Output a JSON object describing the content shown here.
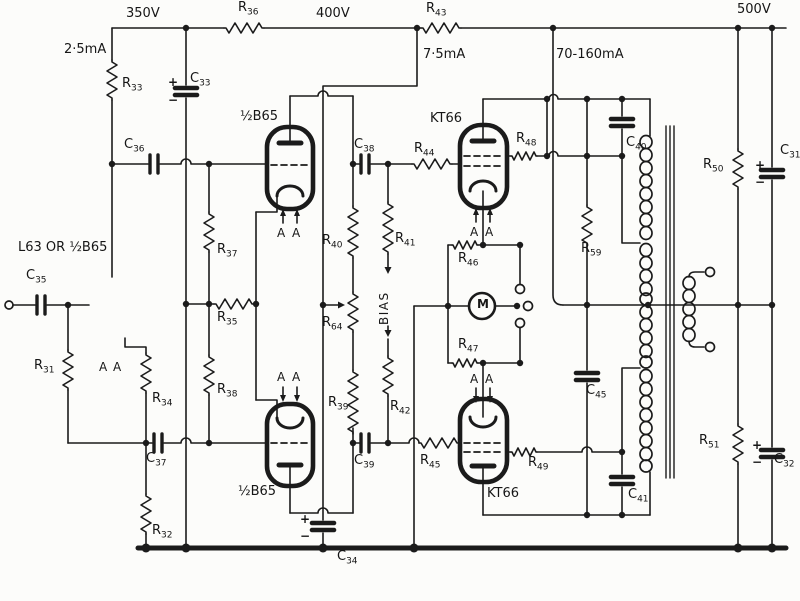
{
  "diagram": {
    "type": "circuit-schematic",
    "subject": "Push-pull KT66 valve power amplifier output stage (Williamson type)",
    "ink_color": "#1b1b1b",
    "paper_color": "#fcfcfa",
    "supply_voltages": [
      "350V",
      "400V",
      "500V"
    ],
    "currents": [
      "2·5mA",
      "7·5mA",
      "70-160mA"
    ],
    "tubes": [
      "L63 OR ½B65",
      "½B65",
      "½B65",
      "KT66",
      "KT66"
    ],
    "meter": "M",
    "bias_label": "BIAS",
    "resistors": [
      "R31",
      "R32",
      "R33",
      "R34",
      "R35",
      "R36",
      "R37",
      "R38",
      "R39",
      "R40",
      "R41",
      "R42",
      "R43",
      "R44",
      "R45",
      "R46",
      "R47",
      "R48",
      "R49",
      "R50",
      "R51",
      "R59",
      "R64"
    ],
    "capacitors": [
      "C31",
      "C32",
      "C33",
      "C34",
      "C35",
      "C36",
      "C37",
      "C38",
      "C39",
      "C40",
      "C41",
      "C45"
    ]
  },
  "labels": {
    "plain": [
      {
        "t": "350V",
        "x": 126,
        "y": 6
      },
      {
        "t": "2·5mA",
        "x": 64,
        "y": 42
      },
      {
        "t": "400V",
        "x": 316,
        "y": 6
      },
      {
        "t": "7·5mA",
        "x": 423,
        "y": 47
      },
      {
        "t": "70-160mA",
        "x": 556,
        "y": 47
      },
      {
        "t": "500V",
        "x": 737,
        "y": 2
      },
      {
        "t": "L63 OR ½B65",
        "x": 18,
        "y": 240
      },
      {
        "t": "½B65",
        "x": 240,
        "y": 109
      },
      {
        "t": "½B65",
        "x": 238,
        "y": 484
      },
      {
        "t": "KT66",
        "x": 430,
        "y": 111
      },
      {
        "t": "KT66",
        "x": 487,
        "y": 486
      },
      {
        "t": "M",
        "x": 477,
        "y": 297,
        "cls": "m"
      },
      {
        "t": "BIAS",
        "x": 377,
        "y": 325,
        "cls": "vert"
      },
      {
        "t": "A",
        "x": 99,
        "y": 360,
        "cls": "aa"
      },
      {
        "t": "A",
        "x": 113,
        "y": 360,
        "cls": "aa"
      },
      {
        "t": "A",
        "x": 277,
        "y": 226,
        "cls": "aa"
      },
      {
        "t": "A",
        "x": 292,
        "y": 226,
        "cls": "aa"
      },
      {
        "t": "A",
        "x": 277,
        "y": 370,
        "cls": "aa"
      },
      {
        "t": "A",
        "x": 292,
        "y": 370,
        "cls": "aa"
      },
      {
        "t": "A",
        "x": 470,
        "y": 225,
        "cls": "aa"
      },
      {
        "t": "A",
        "x": 485,
        "y": 225,
        "cls": "aa"
      },
      {
        "t": "A",
        "x": 470,
        "y": 372,
        "cls": "aa"
      },
      {
        "t": "A",
        "x": 485,
        "y": 372,
        "cls": "aa"
      },
      {
        "t": "+",
        "x": 168,
        "y": 75,
        "cls": "pm"
      },
      {
        "t": "−",
        "x": 168,
        "y": 93,
        "cls": "pm"
      },
      {
        "t": "+",
        "x": 300,
        "y": 512,
        "cls": "pm"
      },
      {
        "t": "−",
        "x": 300,
        "y": 529,
        "cls": "pm"
      },
      {
        "t": "+",
        "x": 755,
        "y": 158,
        "cls": "pm"
      },
      {
        "t": "−",
        "x": 755,
        "y": 175,
        "cls": "pm"
      },
      {
        "t": "+",
        "x": 752,
        "y": 438,
        "cls": "pm"
      },
      {
        "t": "−",
        "x": 752,
        "y": 455,
        "cls": "pm"
      }
    ],
    "subs": [
      {
        "p": "R",
        "s": "36",
        "x": 238,
        "y": 0
      },
      {
        "p": "R",
        "s": "43",
        "x": 426,
        "y": 1
      },
      {
        "p": "R",
        "s": "33",
        "x": 122,
        "y": 76
      },
      {
        "p": "C",
        "s": "33",
        "x": 190,
        "y": 71
      },
      {
        "p": "C",
        "s": "36",
        "x": 124,
        "y": 137
      },
      {
        "p": "R",
        "s": "37",
        "x": 217,
        "y": 242
      },
      {
        "p": "R",
        "s": "35",
        "x": 217,
        "y": 310
      },
      {
        "p": "R",
        "s": "38",
        "x": 217,
        "y": 382
      },
      {
        "p": "C",
        "s": "35",
        "x": 26,
        "y": 268
      },
      {
        "p": "R",
        "s": "31",
        "x": 34,
        "y": 358
      },
      {
        "p": "R",
        "s": "34",
        "x": 152,
        "y": 391
      },
      {
        "p": "C",
        "s": "37",
        "x": 146,
        "y": 451
      },
      {
        "p": "R",
        "s": "32",
        "x": 152,
        "y": 523
      },
      {
        "p": "R",
        "s": "40",
        "x": 322,
        "y": 233
      },
      {
        "p": "R",
        "s": "64",
        "x": 322,
        "y": 315
      },
      {
        "p": "R",
        "s": "39",
        "x": 328,
        "y": 395
      },
      {
        "p": "R",
        "s": "41",
        "x": 395,
        "y": 231
      },
      {
        "p": "R",
        "s": "42",
        "x": 390,
        "y": 399
      },
      {
        "p": "C",
        "s": "38",
        "x": 354,
        "y": 137
      },
      {
        "p": "C",
        "s": "39",
        "x": 354,
        "y": 453
      },
      {
        "p": "R",
        "s": "44",
        "x": 414,
        "y": 141
      },
      {
        "p": "R",
        "s": "45",
        "x": 420,
        "y": 453
      },
      {
        "p": "R",
        "s": "46",
        "x": 458,
        "y": 251
      },
      {
        "p": "R",
        "s": "47",
        "x": 458,
        "y": 337
      },
      {
        "p": "R",
        "s": "48",
        "x": 516,
        "y": 131
      },
      {
        "p": "R",
        "s": "49",
        "x": 528,
        "y": 455
      },
      {
        "p": "C",
        "s": "40",
        "x": 626,
        "y": 135
      },
      {
        "p": "C",
        "s": "41",
        "x": 628,
        "y": 487
      },
      {
        "p": "C",
        "s": "45",
        "x": 586,
        "y": 383
      },
      {
        "p": "R",
        "s": "59",
        "x": 581,
        "y": 241
      },
      {
        "p": "R",
        "s": "50",
        "x": 703,
        "y": 157
      },
      {
        "p": "C",
        "s": "31",
        "x": 780,
        "y": 143
      },
      {
        "p": "R",
        "s": "51",
        "x": 699,
        "y": 433
      },
      {
        "p": "C",
        "s": "32",
        "x": 774,
        "y": 452
      },
      {
        "p": "C",
        "s": "34",
        "x": 337,
        "y": 549
      }
    ]
  }
}
